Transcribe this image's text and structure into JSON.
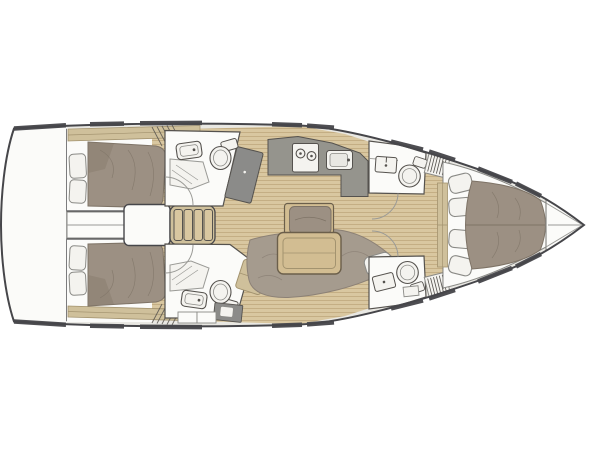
{
  "diagram": {
    "type": "sailing-yacht-interior-floorplan",
    "orientation": "bow-right",
    "decks": 1,
    "rooms": [
      "swim-platform",
      "aft-cabin-port",
      "aft-cabin-starboard",
      "engine-compartment",
      "companionway-stairs",
      "aft-head-port",
      "aft-head-starboard",
      "nav-panel",
      "galley",
      "salon",
      "forward-head-port",
      "forward-head-starboard",
      "forward-cabin",
      "bow-locker"
    ]
  },
  "palette": {
    "page_bg": "#ffffff",
    "hull_line": "#46464a",
    "deck": "#e9e8e3",
    "cabin_white": "#fbfbf9",
    "wood_base": "#d9c7a0",
    "wood_line": "#c4ae84",
    "shelf": "#cfc09b",
    "shelf_line": "#a3936f",
    "bed": "#9c9083",
    "bed_shadow": "#877b6e",
    "bed_line": "#7e7366",
    "sofa": "#a59b8e",
    "sofa_line": "#8c8176",
    "table": "#d2bd92",
    "table_line": "#6b5f4b",
    "counter": "#95948d",
    "panel_dark": "#8b8b89",
    "fixture_line": "#55524e",
    "window": "#4e4e52",
    "cushion": "#f4f3ef",
    "arc": "#9a9a96",
    "detail_line": "#8a8a86"
  }
}
